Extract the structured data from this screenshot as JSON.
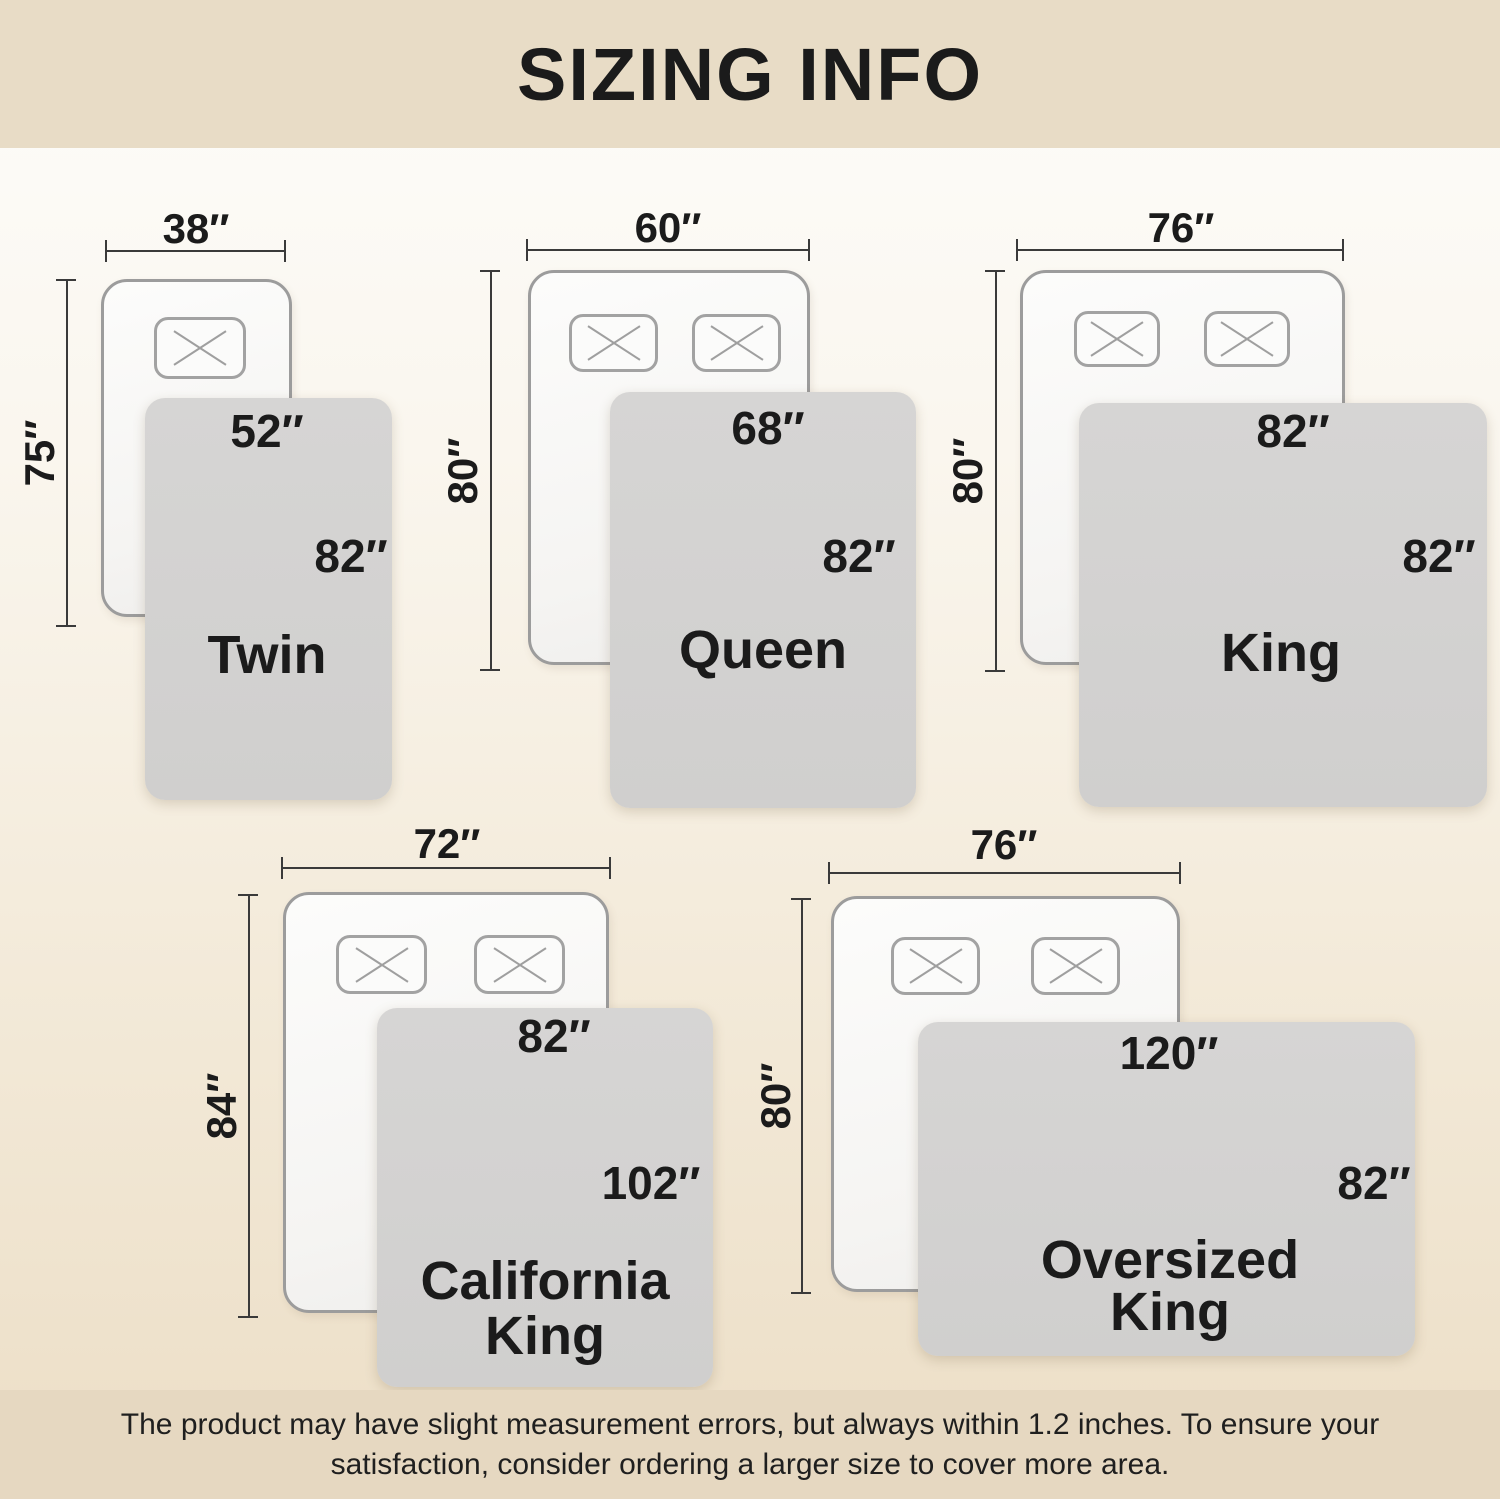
{
  "header": {
    "title": "SIZING INFO"
  },
  "footer": {
    "line1": "The product may have slight measurement errors, but always within 1.2 inches. To ensure your",
    "line2": "satisfaction, consider ordering a larger size to cover more area."
  },
  "colors": {
    "header_banner_bg": "#e8dcc6",
    "footer_banner_bg": "#e6d8c1",
    "page_gradient_top": "#fdfdfb",
    "page_gradient_bottom": "#ecdec6",
    "bed_fill": "#f7f6f4",
    "bed_border": "#9c9c9c",
    "blanket_fill": "#d2d2d1",
    "dimension_line": "#3a3a3a",
    "text": "#1b1b1b"
  },
  "sizes": [
    {
      "name": "Twin",
      "bed_width": "38″",
      "bed_height": "75″",
      "blanket_width": "52″",
      "blanket_height": "82″",
      "name_lines": [
        "Twin"
      ]
    },
    {
      "name": "Queen",
      "bed_width": "60″",
      "bed_height": "80″",
      "blanket_width": "68″",
      "blanket_height": "82″",
      "name_lines": [
        "Queen"
      ]
    },
    {
      "name": "King",
      "bed_width": "76″",
      "bed_height": "80″",
      "blanket_width": "82″",
      "blanket_height": "82″",
      "name_lines": [
        "King"
      ]
    },
    {
      "name": "California King",
      "bed_width": "72″",
      "bed_height": "84″",
      "blanket_width": "82″",
      "blanket_height": "102″",
      "name_lines": [
        "California",
        "King"
      ]
    },
    {
      "name": "Oversized King",
      "bed_width": "76″",
      "bed_height": "80″",
      "blanket_width": "120″",
      "blanket_height": "82″",
      "name_lines": [
        "Oversized",
        "King"
      ]
    }
  ]
}
